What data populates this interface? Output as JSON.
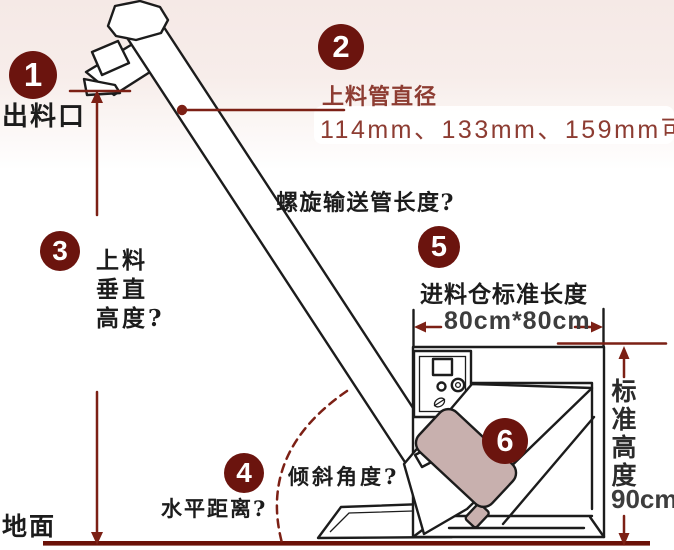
{
  "colors": {
    "badge_fill": "#6b140e",
    "annotation_red": "#7c2015",
    "brick_text": "#8d3c32",
    "ink": "#1c1c1c",
    "motor_fill": "#c8b0ae",
    "ground_line": "#6b1108",
    "bg_top_pink": "#f5e9e6"
  },
  "callouts": {
    "c1": {
      "num": "1",
      "label": "出料口"
    },
    "c2": {
      "num": "2",
      "title": "上料管直径",
      "detail": "114mm、133mm、159mm可"
    },
    "c3": {
      "num": "3",
      "line1": "上料",
      "line2": "垂直",
      "line3": "高度?"
    },
    "c4": {
      "num": "4",
      "label": "水平距离?"
    },
    "c5": {
      "num": "5",
      "title": "进料仓标准长度",
      "detail": "80cm*80cm"
    },
    "c6": {
      "num": "6"
    }
  },
  "annotations": {
    "screw_length": "螺旋输送管长度?",
    "tilt_angle": "倾斜角度?",
    "ground": "地面",
    "std_height": "标准高度",
    "std_height_value": "90cm"
  }
}
